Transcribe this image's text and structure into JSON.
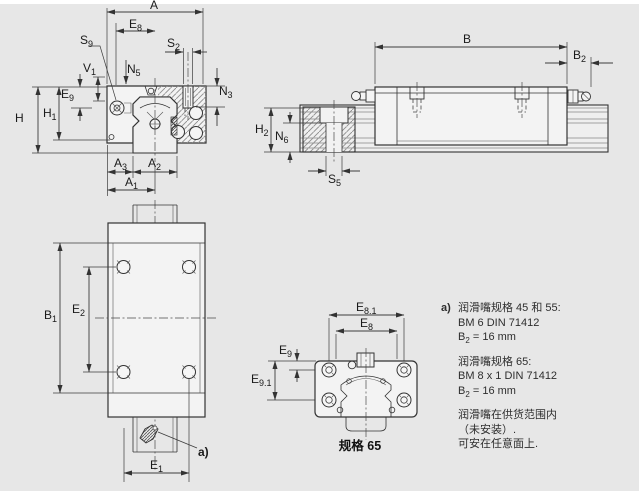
{
  "page": {
    "background": "#e7e7e7",
    "line_color": "#333333"
  },
  "views": {
    "front_section": {
      "dims": {
        "A": {
          "m": "A",
          "s": ""
        },
        "E8": {
          "m": "E",
          "s": "8"
        },
        "S2": {
          "m": "S",
          "s": "2"
        },
        "S9": {
          "m": "S",
          "s": "9"
        },
        "V1": {
          "m": "V",
          "s": "1"
        },
        "N5": {
          "m": "N",
          "s": "5"
        },
        "N3": {
          "m": "N",
          "s": "3"
        },
        "E9": {
          "m": "E",
          "s": "9"
        },
        "H": {
          "m": "H",
          "s": ""
        },
        "H1": {
          "m": "H",
          "s": "1"
        },
        "A3": {
          "m": "A",
          "s": "3"
        },
        "A2": {
          "m": "A",
          "s": "2"
        },
        "A1": {
          "m": "A",
          "s": "1"
        }
      }
    },
    "side_view": {
      "dims": {
        "B": {
          "m": "B",
          "s": ""
        },
        "B2": {
          "m": "B",
          "s": "2"
        },
        "H2": {
          "m": "H",
          "s": "2"
        },
        "N6": {
          "m": "N",
          "s": "6"
        },
        "S5": {
          "m": "S",
          "s": "5"
        }
      }
    },
    "top_view": {
      "dims": {
        "B1": {
          "m": "B",
          "s": "1"
        },
        "E2": {
          "m": "E",
          "s": "2"
        },
        "E1": {
          "m": "E",
          "s": "1"
        }
      },
      "callout": "a)"
    },
    "size65_section": {
      "dims": {
        "E81": {
          "m": "E",
          "s": "8.1"
        },
        "E8": {
          "m": "E",
          "s": "8"
        },
        "E9": {
          "m": "E",
          "s": "9"
        },
        "E91": {
          "m": "E",
          "s": "9.1"
        }
      },
      "caption": "规格 65"
    }
  },
  "notes": {
    "marker": "a)",
    "group1": {
      "l1": "润滑嘴规格 45 和 55:",
      "l2": "BM 6 DIN 71412",
      "l3_pre": "B",
      "l3_sub": "2",
      "l3_post": " = 16 mm"
    },
    "group2": {
      "l1": "润滑嘴规格 65:",
      "l2": "BM 8 x 1 DIN 71412",
      "l3_pre": "B",
      "l3_sub": "2",
      "l3_post": " = 16 mm"
    },
    "group3": {
      "l1": "润滑嘴在供货范围内",
      "l2": "（未安装）.",
      "l3": "可安在任意面上."
    }
  }
}
